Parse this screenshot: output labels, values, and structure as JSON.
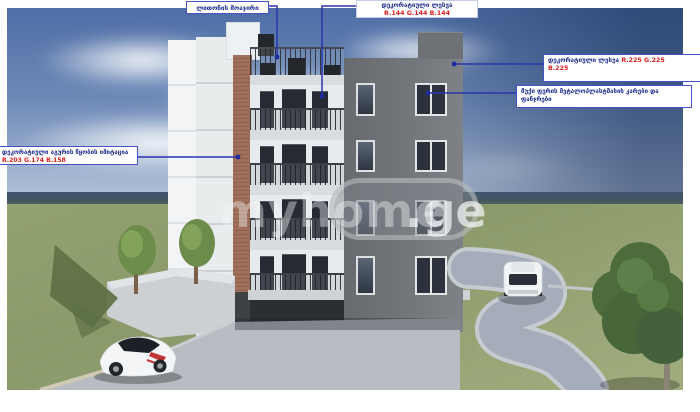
{
  "watermark": {
    "main": "myhome",
    "suffix": ".ge"
  },
  "annotations": {
    "railing": {
      "label": "ლითონის მოაჯირი"
    },
    "plaster_gray": {
      "label": "დეკორატიული ლესვა",
      "rgb": "R.144 G.144 B.144"
    },
    "plaster_light": {
      "label": "დეკორატიული ლესვა",
      "rgb_line1": "R.225 G.225",
      "rgb_line2": "B.225"
    },
    "openings": {
      "line1": "მუქი ფერის მეტალოპლასტმასის კარები და",
      "line2": "ფანჯრები"
    },
    "brick": {
      "label": "დეკორატიული აგურის წყობის იმიტაცია",
      "rgb": "R.203 G.174 B.158"
    }
  },
  "colors": {
    "annotation_line": "#2a35ad",
    "label_text": "#1f2d8f",
    "value_red": "#e02020",
    "facade_gray": "#74777c",
    "brick": "#9a6c57",
    "plaster_white": "#e9eced",
    "grass": "#8e9d6e",
    "sky": "#5b79ab"
  }
}
